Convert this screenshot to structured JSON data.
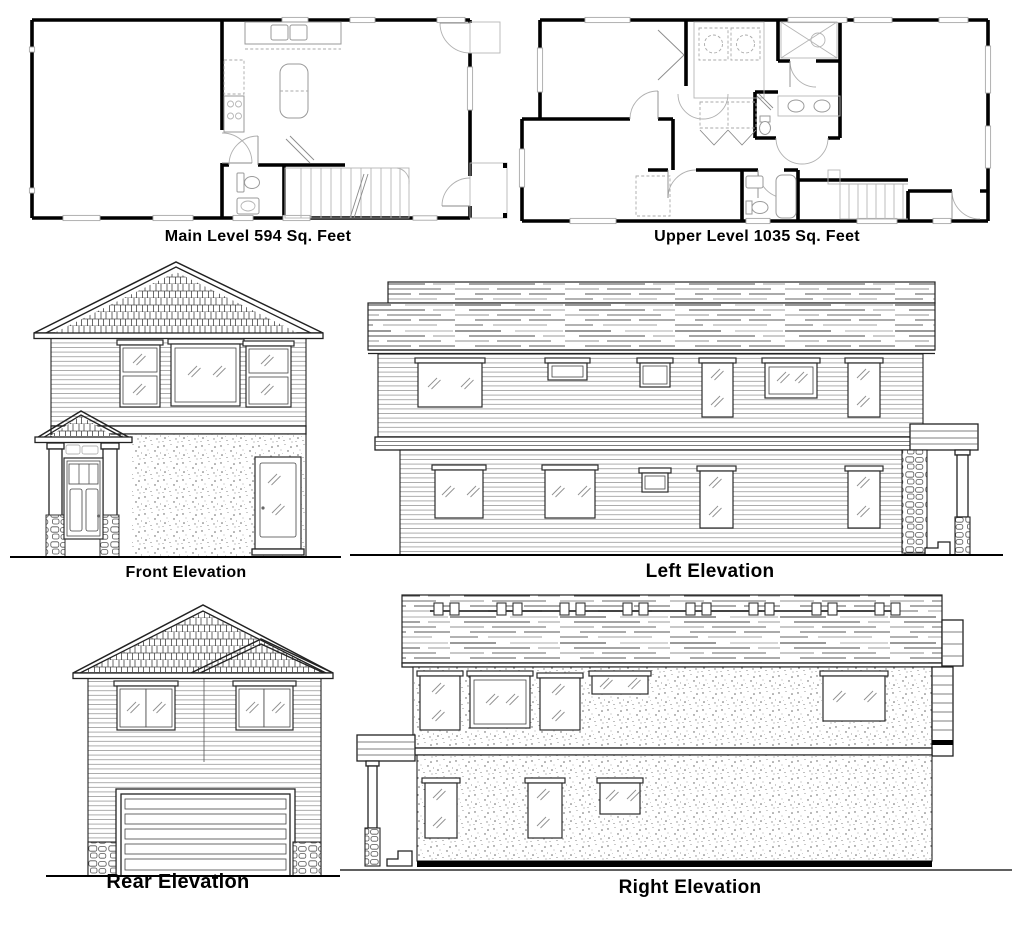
{
  "sheet": {
    "background": "#ffffff",
    "ink": "#000000",
    "detail_gray": "#8a8a8a"
  },
  "floor_plans": {
    "main": {
      "label": "Main Level 594 Sq. Feet",
      "name": "Main Level",
      "area_sq_feet": 594
    },
    "upper": {
      "label": "Upper Level 1035 Sq. Feet",
      "name": "Upper Level",
      "area_sq_feet": 1035
    }
  },
  "elevations": {
    "front": {
      "label": "Front Elevation"
    },
    "left": {
      "label": "Left Elevation"
    },
    "rear": {
      "label": "Rear Elevation"
    },
    "right": {
      "label": "Right Elevation"
    }
  }
}
